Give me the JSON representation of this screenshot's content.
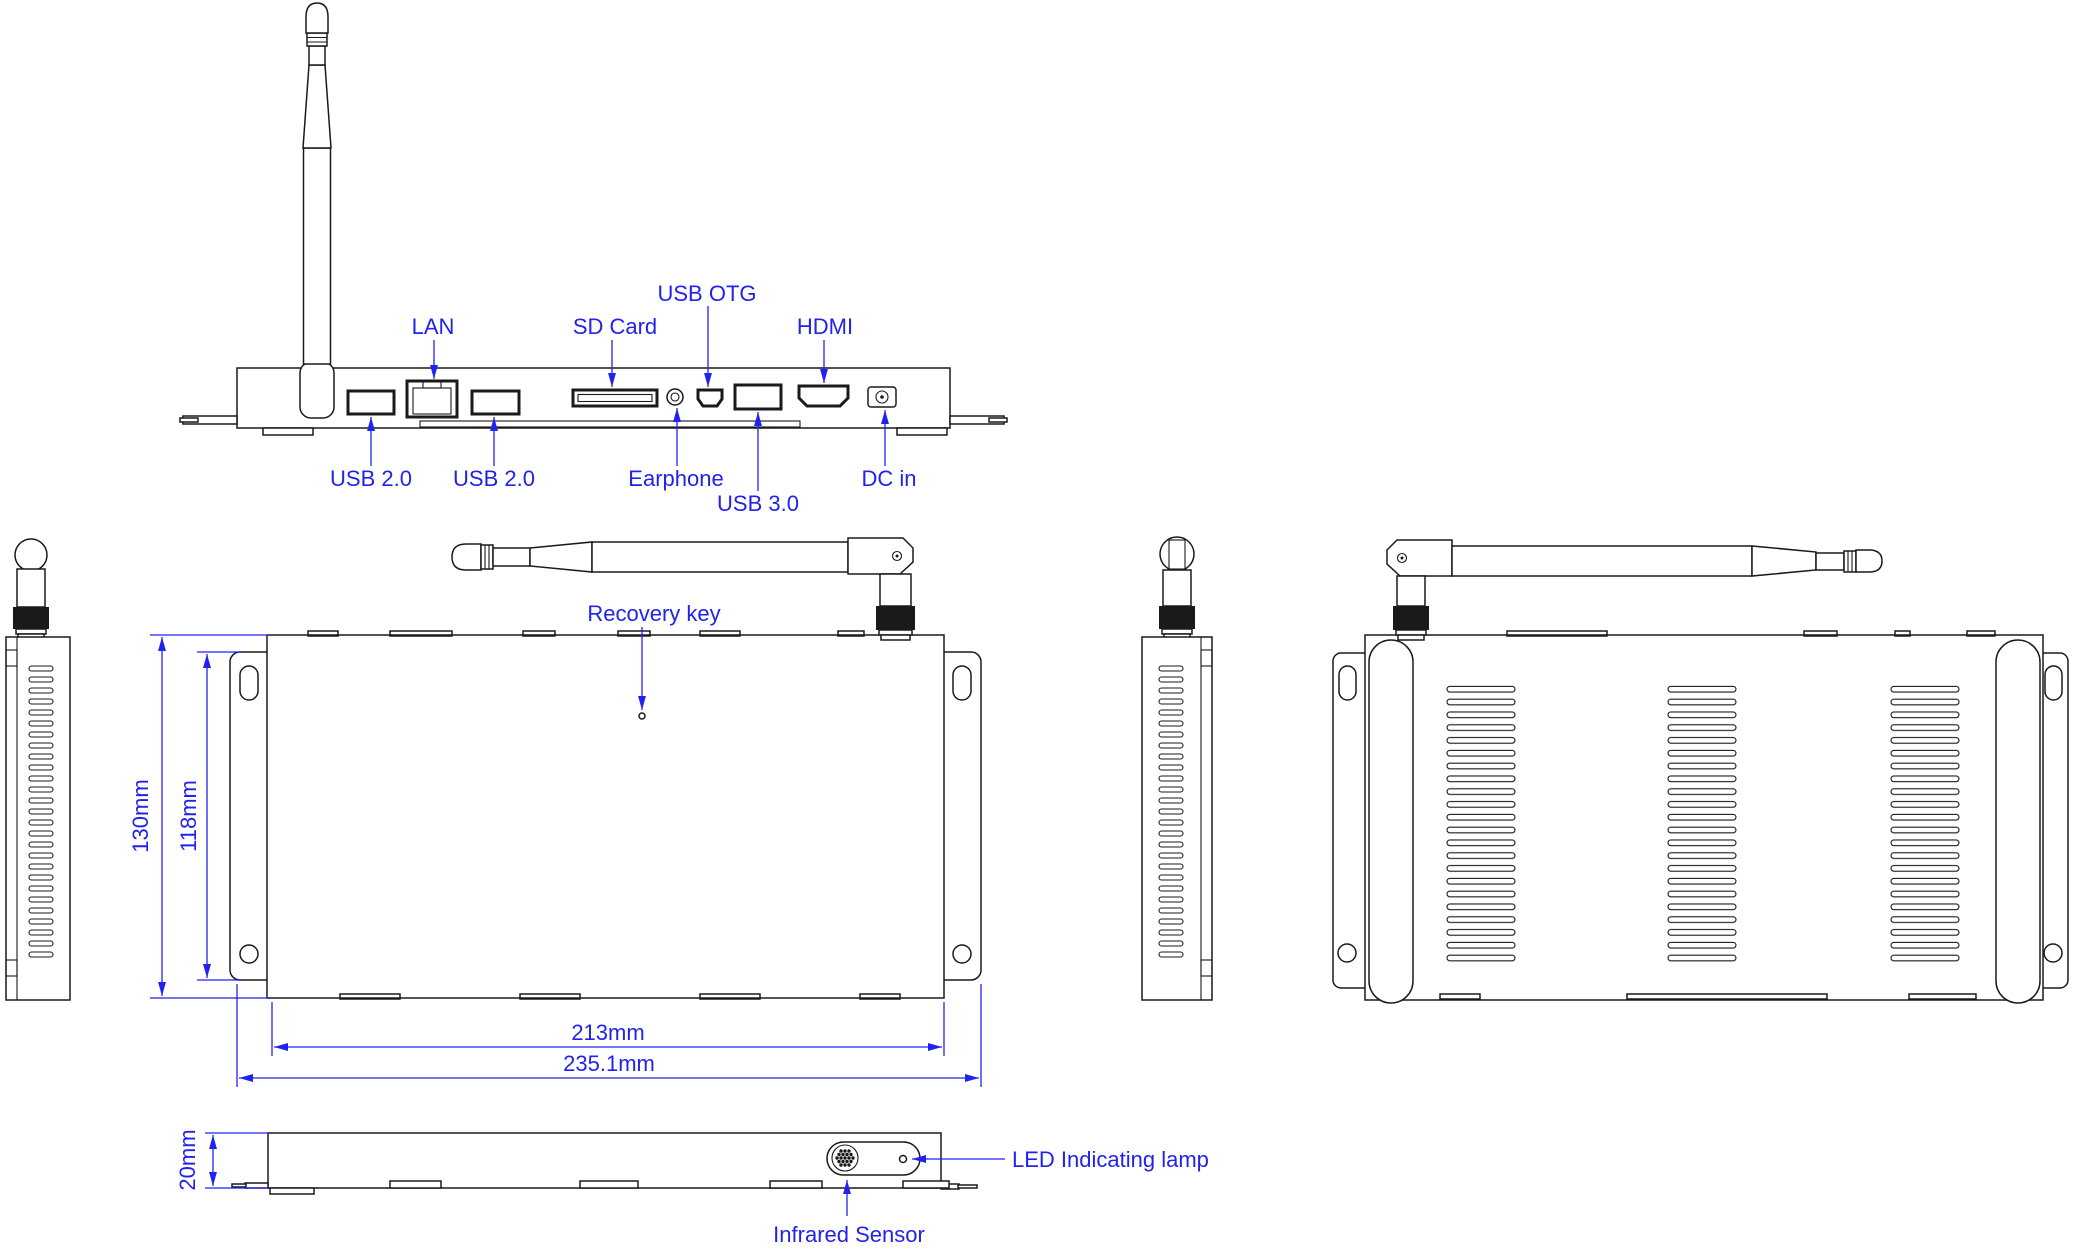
{
  "colors": {
    "accent": "#2222ee",
    "line": "#1a1a1a",
    "background": "#ffffff"
  },
  "rear_view": {
    "labels_top": {
      "lan": "LAN",
      "sd_card": "SD Card",
      "usb_otg": "USB OTG",
      "hdmi": "HDMI"
    },
    "labels_bottom": {
      "usb2_left": "USB 2.0",
      "usb2_right": "USB 2.0",
      "earphone": "Earphone",
      "usb3": "USB 3.0",
      "dc_in": "DC in"
    }
  },
  "top_view": {
    "recovery_key": "Recovery key"
  },
  "front_view": {
    "led": "LED Indicating lamp",
    "infrared": "Infrared Sensor"
  },
  "dimensions": {
    "overall_height": "130mm",
    "mount_hole_span": "118mm",
    "body_width": "213mm",
    "overall_width": "235.1mm",
    "thickness": "20mm"
  }
}
